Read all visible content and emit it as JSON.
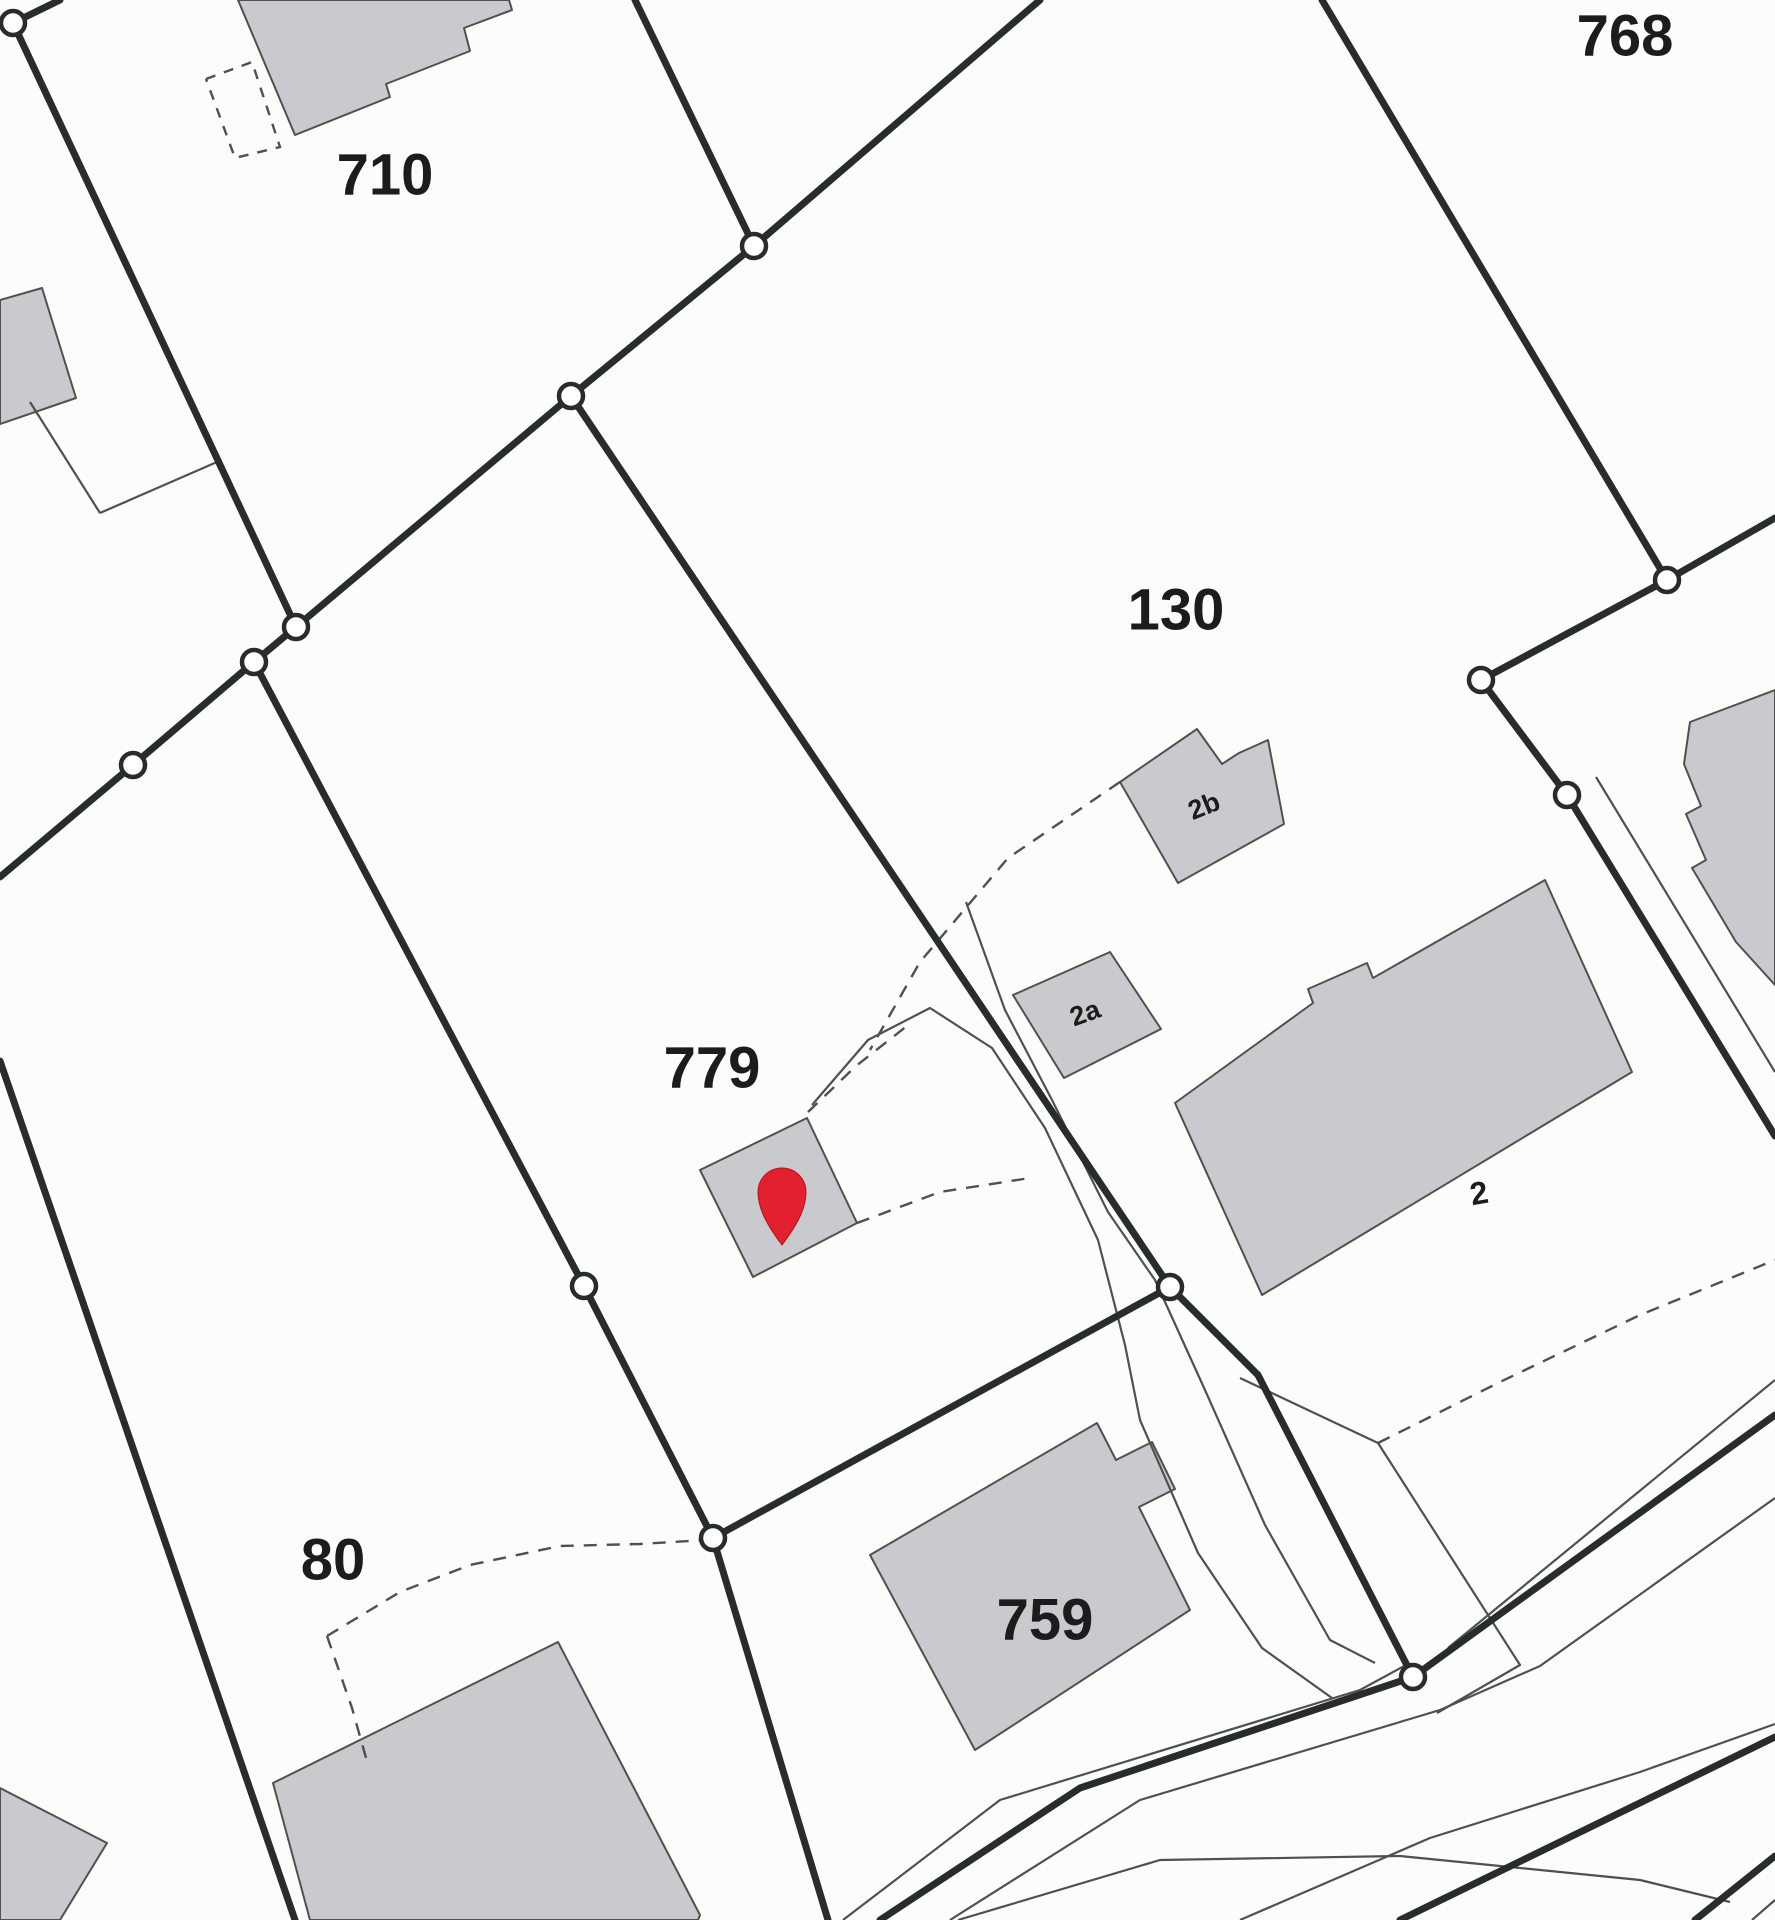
{
  "map": {
    "kind": "cadastral-parcel-map-scan",
    "canvas": {
      "width": 1775,
      "height": 1920,
      "background": "#fcfcfb"
    },
    "colors": {
      "boundary_thick": "#282d2a",
      "line_thin": "#4d5250",
      "line_dashed": "#4d5250",
      "building_fill": "#c9cacd",
      "building_stroke": "#50514f",
      "vertex_fill": "#ffffff",
      "vertex_stroke": "#282d2a",
      "label": "#1a1d1b",
      "pin": "#e3212e"
    },
    "labels": [
      {
        "name": "parcel-label-710",
        "text": "710",
        "x": 385,
        "y": 175,
        "size": 58,
        "rotate": 0
      },
      {
        "name": "parcel-label-768",
        "text": "768",
        "x": 1625,
        "y": 36,
        "size": 58,
        "rotate": 0
      },
      {
        "name": "parcel-label-130",
        "text": "130",
        "x": 1176,
        "y": 610,
        "size": 58,
        "rotate": 0
      },
      {
        "name": "parcel-label-779",
        "text": "779",
        "x": 712,
        "y": 1068,
        "size": 58,
        "rotate": 0
      },
      {
        "name": "parcel-label-80",
        "text": "80",
        "x": 333,
        "y": 1560,
        "size": 58,
        "rotate": 0
      },
      {
        "name": "parcel-label-759",
        "text": "759",
        "x": 1045,
        "y": 1620,
        "size": 58,
        "rotate": 0
      },
      {
        "name": "building-label-2b",
        "text": "2b",
        "x": 1204,
        "y": 806,
        "size": 27,
        "rotate": -22
      },
      {
        "name": "building-label-2a",
        "text": "2a",
        "x": 1085,
        "y": 1013,
        "size": 27,
        "rotate": -20
      },
      {
        "name": "building-label-2",
        "text": "2",
        "x": 1479,
        "y": 1193,
        "size": 32,
        "rotate": -10
      }
    ],
    "buildings": [
      {
        "name": "building-710",
        "points": [
          [
            238,
            0
          ],
          [
            295,
            135
          ],
          [
            390,
            97
          ],
          [
            386,
            84
          ],
          [
            470,
            51
          ],
          [
            464,
            28
          ],
          [
            512,
            10
          ],
          [
            509,
            0
          ]
        ]
      },
      {
        "name": "building-west-edge",
        "points": [
          [
            0,
            300
          ],
          [
            42,
            288
          ],
          [
            76,
            398
          ],
          [
            0,
            424
          ]
        ]
      },
      {
        "name": "building-2b",
        "points": [
          [
            1120,
            782
          ],
          [
            1197,
            729
          ],
          [
            1222,
            764
          ],
          [
            1239,
            753
          ],
          [
            1268,
            740
          ],
          [
            1284,
            824
          ],
          [
            1178,
            883
          ]
        ]
      },
      {
        "name": "building-2a",
        "points": [
          [
            1013,
            995
          ],
          [
            1110,
            952
          ],
          [
            1161,
            1029
          ],
          [
            1064,
            1078
          ]
        ]
      },
      {
        "name": "building-2",
        "points": [
          [
            1175,
            1103
          ],
          [
            1313,
            1003
          ],
          [
            1308,
            989
          ],
          [
            1367,
            963
          ],
          [
            1373,
            978
          ],
          [
            1545,
            880
          ],
          [
            1632,
            1072
          ],
          [
            1262,
            1295
          ]
        ]
      },
      {
        "name": "building-pin-shed-779",
        "points": [
          [
            700,
            1170
          ],
          [
            807,
            1118
          ],
          [
            857,
            1223
          ],
          [
            753,
            1277
          ]
        ]
      },
      {
        "name": "building-759",
        "points": [
          [
            1097,
            1423
          ],
          [
            1116,
            1460
          ],
          [
            1152,
            1442
          ],
          [
            1175,
            1489
          ],
          [
            1139,
            1507
          ],
          [
            1190,
            1610
          ],
          [
            975,
            1750
          ],
          [
            870,
            1555
          ]
        ]
      },
      {
        "name": "building-80",
        "points": [
          [
            273,
            1783
          ],
          [
            558,
            1642
          ],
          [
            700,
            1915
          ],
          [
            698,
            1920
          ],
          [
            310,
            1920
          ]
        ]
      },
      {
        "name": "building-sw-corner",
        "points": [
          [
            0,
            1788
          ],
          [
            107,
            1843
          ],
          [
            60,
            1920
          ],
          [
            0,
            1920
          ]
        ]
      },
      {
        "name": "building-east-edge",
        "points": [
          [
            1690,
            722
          ],
          [
            1775,
            690
          ],
          [
            1775,
            985
          ],
          [
            1736,
            942
          ],
          [
            1692,
            868
          ],
          [
            1706,
            860
          ],
          [
            1686,
            814
          ],
          [
            1701,
            806
          ],
          [
            1684,
            764
          ]
        ]
      }
    ],
    "boundaries_thick": [
      {
        "name": "boundary-nw",
        "points": [
          [
            60,
            0
          ],
          [
            13,
            23
          ],
          [
            296,
            627
          ]
        ]
      },
      {
        "name": "boundary-mid-diagonal",
        "points": [
          [
            296,
            627
          ],
          [
            571,
            396
          ],
          [
            754,
            246
          ],
          [
            635,
            0
          ]
        ]
      },
      {
        "name": "boundary-d-northeast",
        "points": [
          [
            754,
            246
          ],
          [
            1040,
            0
          ]
        ]
      },
      {
        "name": "boundary-779-130",
        "points": [
          [
            571,
            396
          ],
          [
            1170,
            1287
          ]
        ]
      },
      {
        "name": "boundary-sw-cross",
        "points": [
          [
            296,
            627
          ],
          [
            254,
            662
          ],
          [
            133,
            765
          ],
          [
            0,
            877
          ]
        ]
      },
      {
        "name": "boundary-779-west",
        "points": [
          [
            254,
            662
          ],
          [
            584,
            1286
          ],
          [
            713,
            1538
          ]
        ]
      },
      {
        "name": "boundary-south",
        "points": [
          [
            713,
            1538
          ],
          [
            828,
            1920
          ]
        ]
      },
      {
        "name": "boundary-759-north",
        "points": [
          [
            713,
            1538
          ],
          [
            1170,
            1287
          ]
        ]
      },
      {
        "name": "boundary-759-east",
        "points": [
          [
            1170,
            1287
          ],
          [
            1258,
            1375
          ],
          [
            1413,
            1677
          ]
        ]
      },
      {
        "name": "boundary-768-west",
        "points": [
          [
            1322,
            0
          ],
          [
            1667,
            580
          ]
        ]
      },
      {
        "name": "boundary-768-south",
        "points": [
          [
            1667,
            580
          ],
          [
            1775,
            518
          ]
        ]
      },
      {
        "name": "boundary-a-b",
        "points": [
          [
            1667,
            580
          ],
          [
            1481,
            680
          ]
        ]
      },
      {
        "name": "boundary-b-c-se",
        "points": [
          [
            1481,
            680
          ],
          [
            1567,
            795
          ],
          [
            1775,
            1136
          ]
        ]
      },
      {
        "name": "road-centerline",
        "points": [
          [
            880,
            1920
          ],
          [
            1080,
            1788
          ],
          [
            1413,
            1677
          ],
          [
            1775,
            1415
          ]
        ]
      },
      {
        "name": "road2-centerline",
        "points": [
          [
            1400,
            1920
          ],
          [
            1775,
            1737
          ]
        ]
      },
      {
        "name": "road-corner-line",
        "points": [
          [
            1695,
            1920
          ],
          [
            1775,
            1856
          ]
        ]
      },
      {
        "name": "boundary-80-west",
        "points": [
          [
            0,
            1061
          ],
          [
            295,
            1920
          ]
        ]
      }
    ],
    "lines_thin": [
      {
        "name": "outline-west-parcel-a",
        "points": [
          [
            30,
            402
          ],
          [
            100,
            513
          ]
        ]
      },
      {
        "name": "outline-west-parcel-b",
        "points": [
          [
            100,
            513
          ],
          [
            217,
            462
          ]
        ]
      },
      {
        "name": "lane-west-edge",
        "points": [
          [
            812,
            1105
          ],
          [
            868,
            1040
          ],
          [
            930,
            1008
          ],
          [
            992,
            1048
          ],
          [
            1045,
            1128
          ],
          [
            1098,
            1240
          ],
          [
            1125,
            1345
          ],
          [
            1140,
            1420
          ],
          [
            1198,
            1553
          ],
          [
            1262,
            1648
          ],
          [
            1332,
            1698
          ]
        ]
      },
      {
        "name": "lane-east-edge",
        "points": [
          [
            966,
            902
          ],
          [
            1005,
            1010
          ],
          [
            1052,
            1100
          ],
          [
            1108,
            1212
          ],
          [
            1155,
            1280
          ],
          [
            1205,
            1390
          ],
          [
            1265,
            1525
          ],
          [
            1330,
            1640
          ],
          [
            1375,
            1663
          ]
        ]
      },
      {
        "name": "road-nw-edge",
        "points": [
          [
            843,
            1920
          ],
          [
            1000,
            1800
          ],
          [
            1360,
            1690
          ],
          [
            1406,
            1665
          ]
        ]
      },
      {
        "name": "road-ne-edge",
        "points": [
          [
            1448,
            1648
          ],
          [
            1775,
            1380
          ]
        ]
      },
      {
        "name": "road-se-edge",
        "points": [
          [
            950,
            1920
          ],
          [
            1140,
            1800
          ],
          [
            1440,
            1710
          ],
          [
            1540,
            1666
          ],
          [
            1775,
            1498
          ]
        ]
      },
      {
        "name": "parcel-corner-east",
        "points": [
          [
            1240,
            1378
          ],
          [
            1378,
            1443
          ],
          [
            1520,
            1665
          ],
          [
            1437,
            1713
          ]
        ]
      },
      {
        "name": "lane-east-of-building-2",
        "points": [
          [
            1596,
            777
          ],
          [
            1775,
            1072
          ]
        ]
      },
      {
        "name": "road2-north-edge",
        "points": [
          [
            1240,
            1920
          ],
          [
            1430,
            1838
          ],
          [
            1640,
            1772
          ],
          [
            1775,
            1724
          ]
        ]
      },
      {
        "name": "road-merge-curve",
        "points": [
          [
            958,
            1920
          ],
          [
            1160,
            1860
          ],
          [
            1400,
            1856
          ],
          [
            1640,
            1880
          ],
          [
            1730,
            1902
          ]
        ]
      },
      {
        "name": "road2-corner-edge",
        "points": [
          [
            1752,
            1920
          ],
          [
            1775,
            1900
          ]
        ]
      }
    ],
    "lines_dashed": [
      {
        "name": "annex-710-dashed",
        "dash": "10 9",
        "points": [
          [
            206,
            79
          ],
          [
            252,
            62
          ],
          [
            280,
            147
          ],
          [
            235,
            158
          ],
          [
            206,
            79
          ]
        ]
      },
      {
        "name": "path-2b-to-lane",
        "dash": "13 10",
        "points": [
          [
            1120,
            782
          ],
          [
            1008,
            858
          ],
          [
            920,
            962
          ],
          [
            870,
            1050
          ]
        ]
      },
      {
        "name": "path-pin-northeast",
        "dash": "13 10",
        "points": [
          [
            808,
            1112
          ],
          [
            856,
            1066
          ],
          [
            912,
            1022
          ]
        ]
      },
      {
        "name": "path-pin-east",
        "dash": "13 10",
        "points": [
          [
            857,
            1223
          ],
          [
            940,
            1192
          ],
          [
            1030,
            1178
          ]
        ]
      },
      {
        "name": "curve-80",
        "dash": "13 10",
        "points": [
          [
            327,
            1636
          ],
          [
            400,
            1592
          ],
          [
            470,
            1565
          ],
          [
            560,
            1546
          ],
          [
            640,
            1544
          ],
          [
            706,
            1540
          ]
        ]
      },
      {
        "name": "path-80-south",
        "dash": "13 10",
        "points": [
          [
            327,
            1636
          ],
          [
            352,
            1708
          ],
          [
            368,
            1765
          ]
        ]
      },
      {
        "name": "path-southeast",
        "dash": "13 10",
        "points": [
          [
            1378,
            1443
          ],
          [
            1500,
            1382
          ],
          [
            1640,
            1315
          ],
          [
            1775,
            1260
          ]
        ]
      }
    ],
    "vertex_markers": [
      [
        13,
        23
      ],
      [
        754,
        246
      ],
      [
        571,
        396
      ],
      [
        296,
        627
      ],
      [
        254,
        662
      ],
      [
        133,
        765
      ],
      [
        1667,
        580
      ],
      [
        1481,
        680
      ],
      [
        1567,
        795
      ],
      [
        584,
        1286
      ],
      [
        713,
        1538
      ],
      [
        1170,
        1287
      ],
      [
        1413,
        1677
      ]
    ],
    "pin_marker": {
      "cx": 782,
      "cy": 1192,
      "r": 24,
      "tip_y": 1245
    }
  }
}
